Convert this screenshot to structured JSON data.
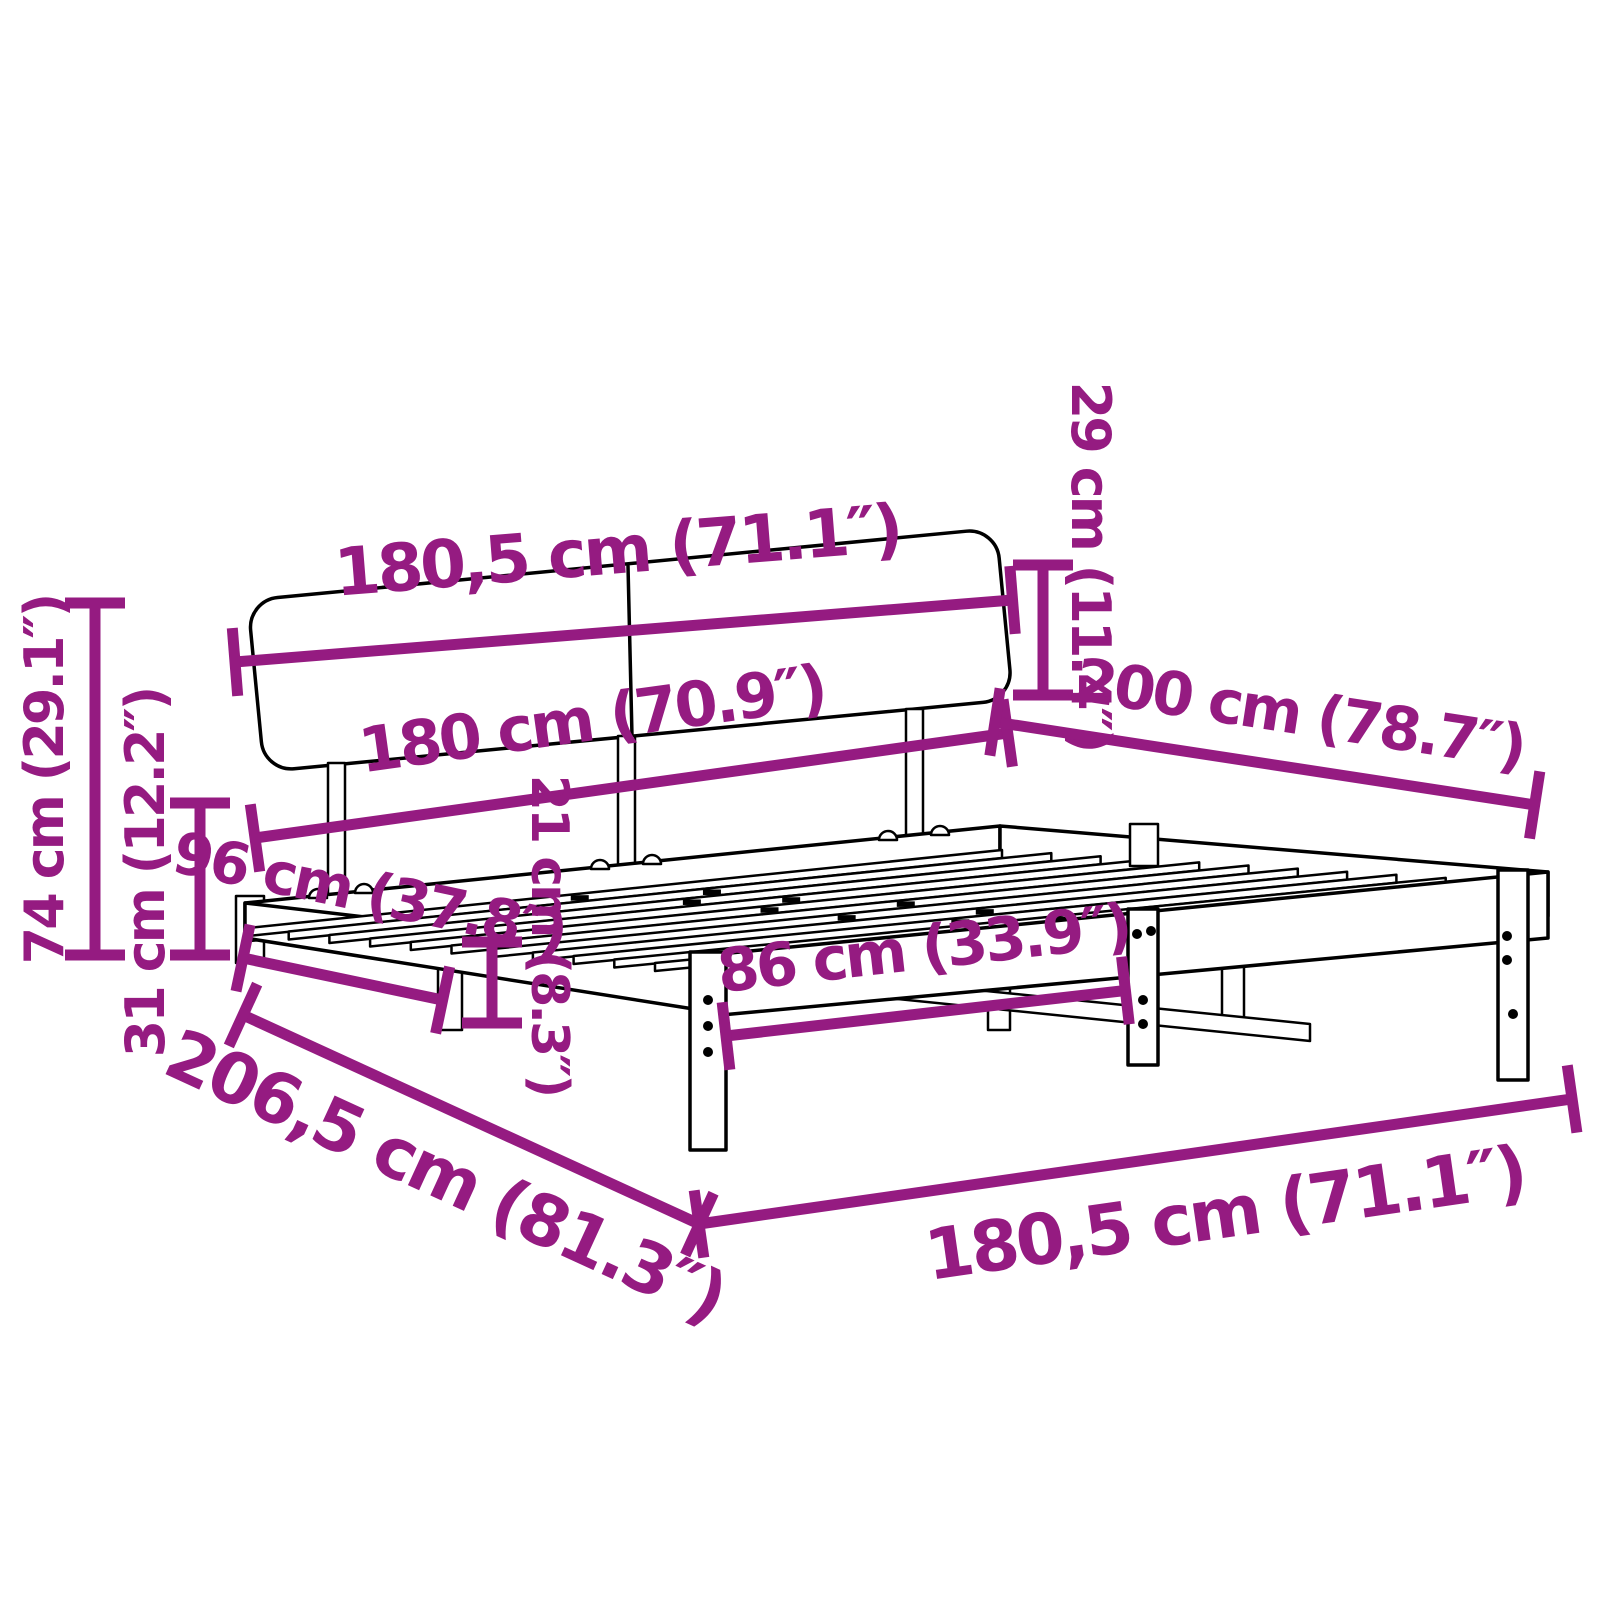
{
  "diagram": {
    "type": "product-dimension-diagram",
    "subject": "bed-frame-with-headboard",
    "background_color": "#ffffff",
    "drawing_color": "#000000",
    "dimension_color": "#951b81",
    "dimensions": {
      "headboard_width_top": "180,5 cm (71.1″)",
      "headboard_panel_height": "29 cm (11.4″)",
      "bed_width": "180 cm (70.9″)",
      "bed_length": "200 cm (78.7″)",
      "total_height": "74 cm (29.1″)",
      "frame_height": "31 cm (12.2″)",
      "side_leg_spacing": "96 cm (37.8″)",
      "under_bed_clearance": "21 cm (8.3″)",
      "front_leg_spacing": "86 cm (33.9″)",
      "frame_width_front": "180,5 cm (71.1″)",
      "total_length": "206,5 cm (81.3″)"
    },
    "slat_count": 12
  }
}
